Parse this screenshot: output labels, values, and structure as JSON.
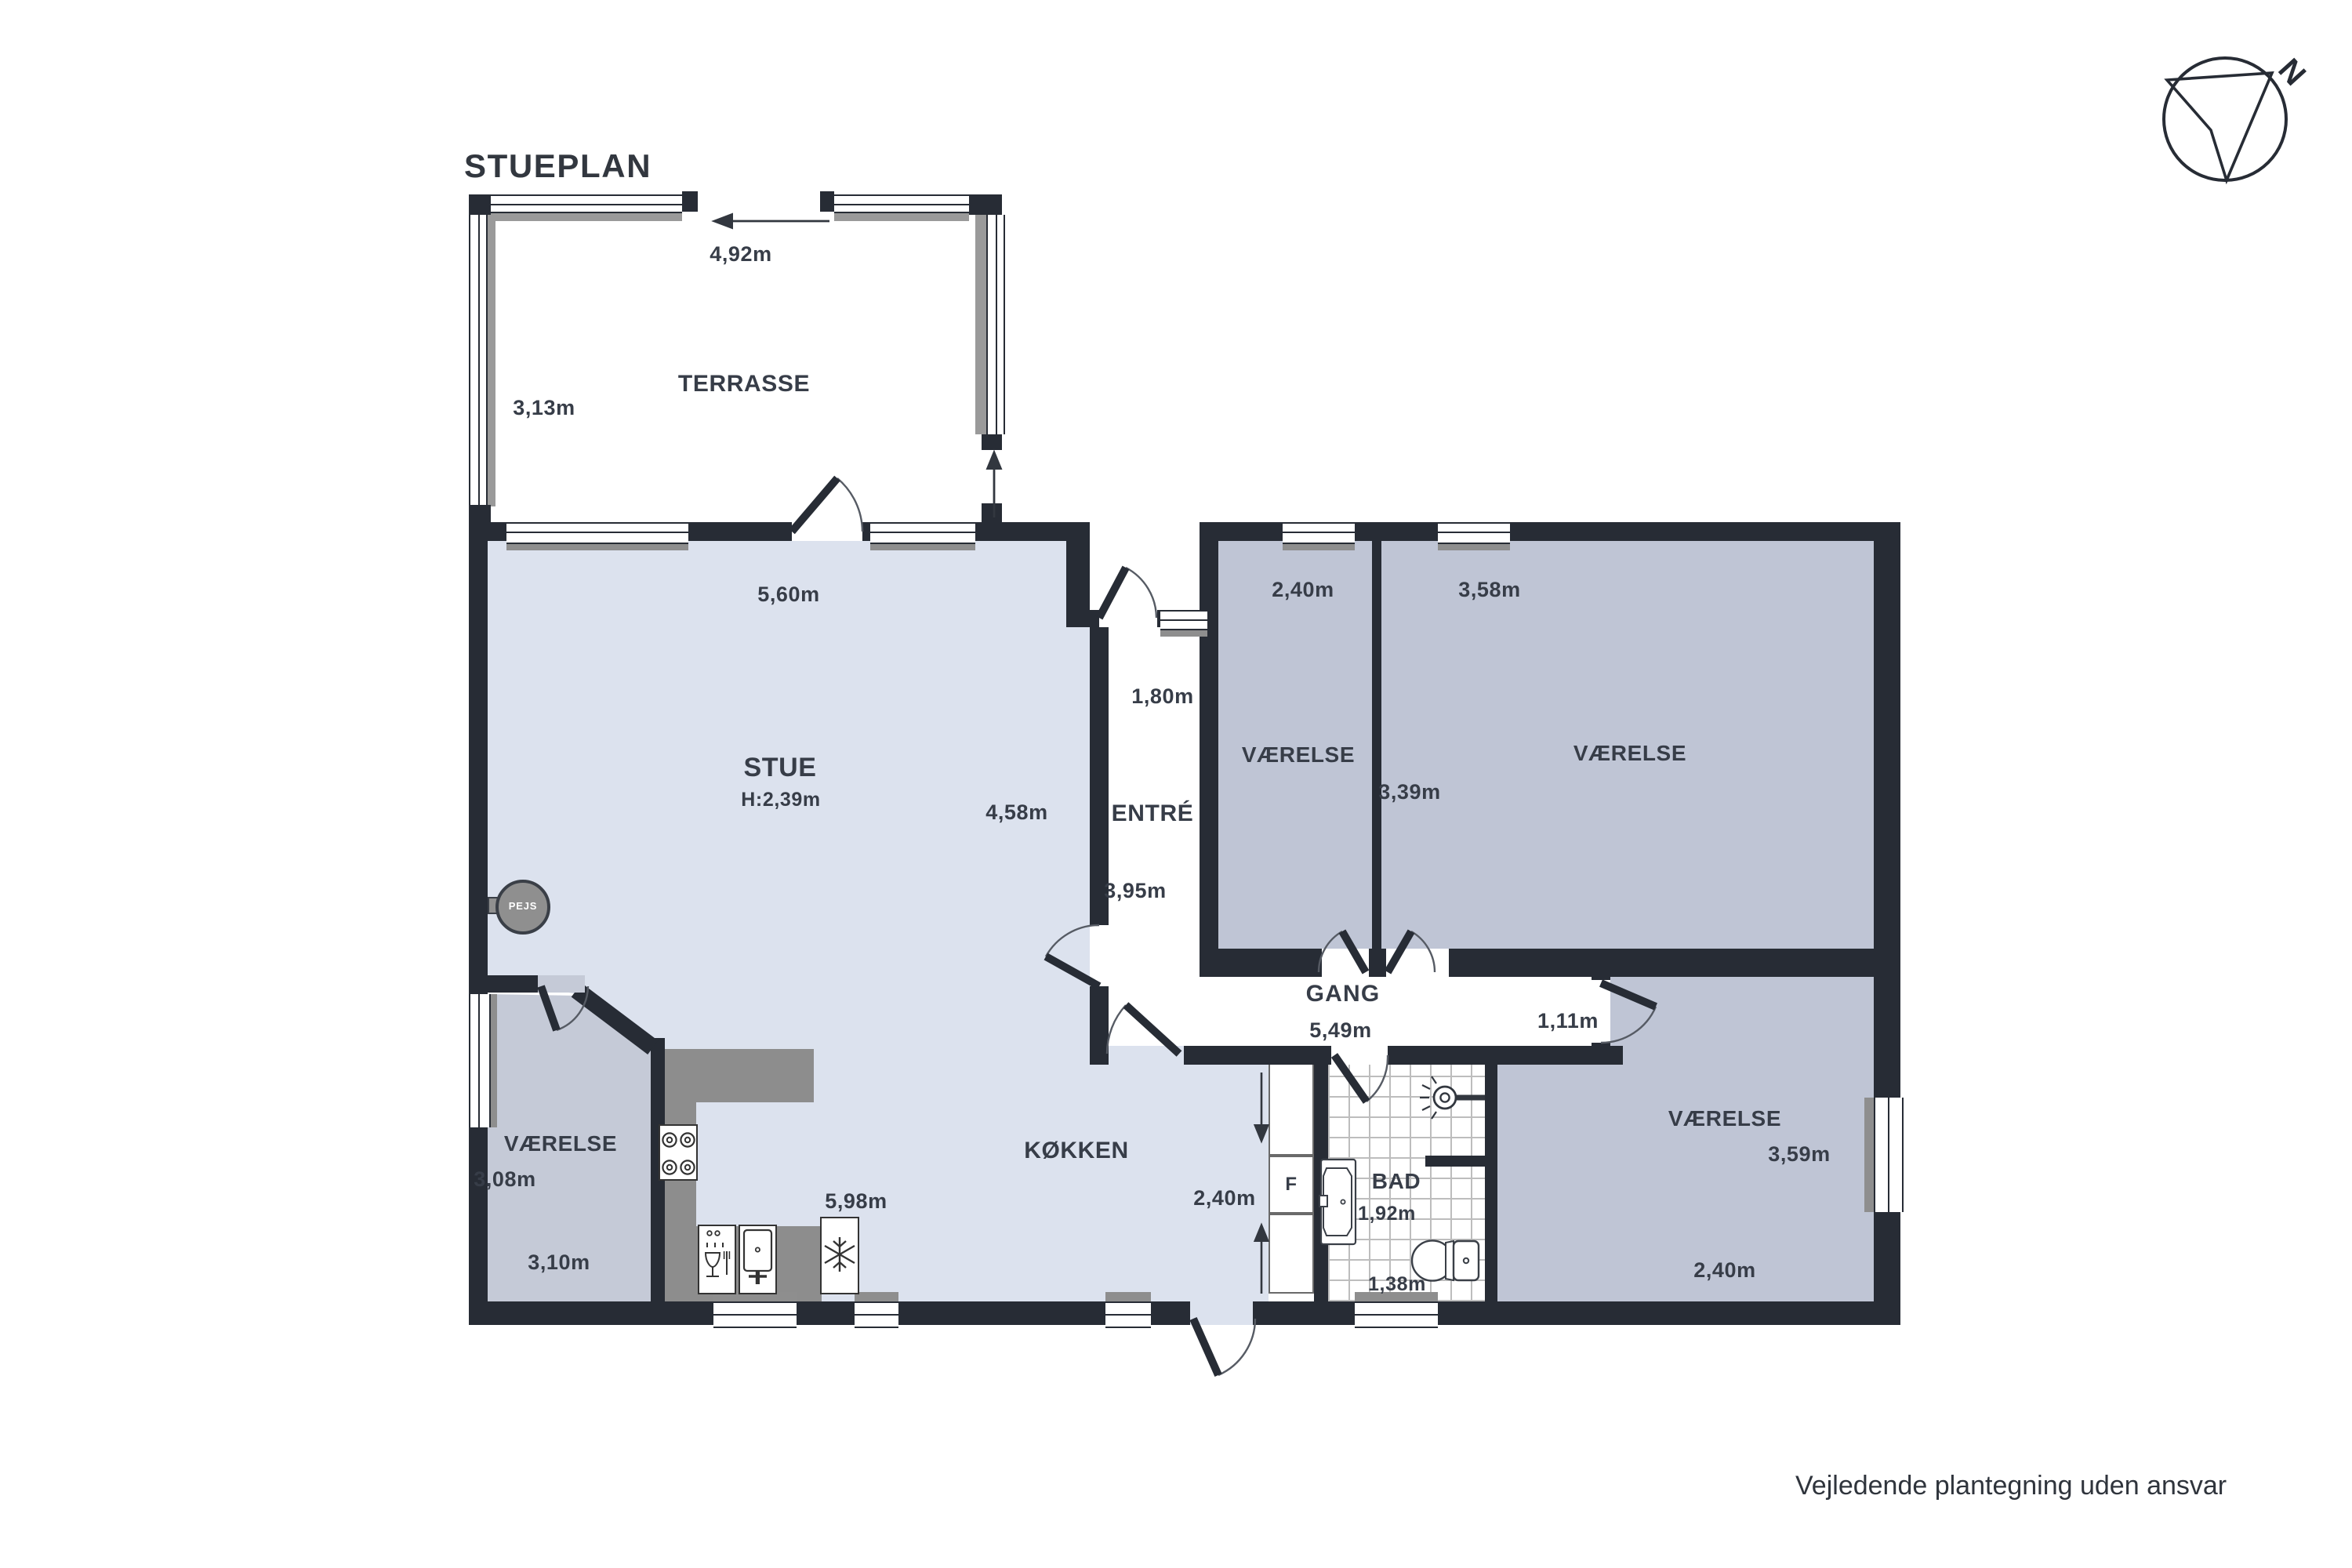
{
  "title": "STUEPLAN",
  "footer": "Vejledende plantegning uden ansvar",
  "compass": {
    "north_label": "N"
  },
  "colors": {
    "wall": "#272c35",
    "light_floor": "#dce2ee",
    "gray_floor": "#bfc5d5",
    "counter": "#8d8d8d",
    "text": "#373d48"
  },
  "rooms": {
    "terrasse": {
      "name": "TERRASSE",
      "width": "4,92m",
      "depth": "3,13m"
    },
    "stue": {
      "name": "STUE",
      "ceiling_height": "H:2,39m",
      "width": "5,60m",
      "depth": "4,58m"
    },
    "entre": {
      "name": "ENTRÉ",
      "width": "1,80m",
      "depth": "3,95m"
    },
    "vaerelse_ne1": {
      "name": "VÆRELSE",
      "width": "2,40m"
    },
    "vaerelse_ne2": {
      "name": "VÆRELSE",
      "width": "3,58m",
      "depth": "3,39m"
    },
    "gang": {
      "name": "GANG",
      "length": "5,49m",
      "width": "1,11m"
    },
    "kokken": {
      "name": "KØKKEN",
      "length": "5,98m",
      "width": "2,40m",
      "fridge_label": "F"
    },
    "bad": {
      "name": "BAD",
      "width": "1,92m",
      "depth": "1,38m"
    },
    "vaerelse_se": {
      "name": "VÆRELSE",
      "depth": "3,59m",
      "width": "2,40m"
    },
    "vaerelse_sw": {
      "name": "VÆRELSE",
      "depth": "3,08m",
      "width": "3,10m"
    },
    "pejs": {
      "label": "PEJS"
    }
  }
}
